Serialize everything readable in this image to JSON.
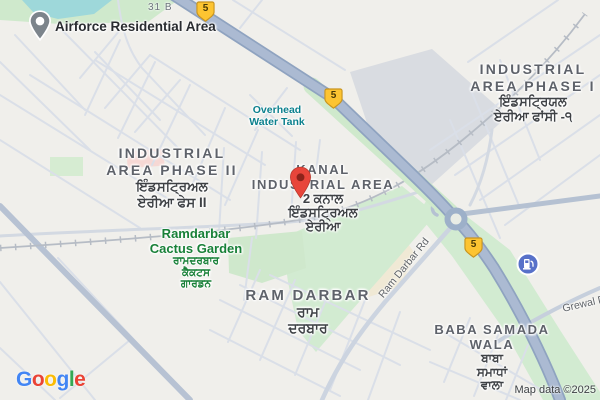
{
  "attribution": "Map data ©2025",
  "logo": {
    "letters": [
      "G",
      "o",
      "o",
      "g",
      "l",
      "e"
    ]
  },
  "badges": [
    {
      "label": "5"
    },
    {
      "label": "5"
    },
    {
      "label": "5"
    }
  ],
  "road_labels": {
    "plot": "31 B",
    "ram_darbar_rd": "Ram Darbar Rd",
    "grewal": "Grewal D"
  },
  "places": {
    "airforce": {
      "label": "Airforce Residential Area"
    },
    "water_tank": {
      "lines": [
        "Overhead",
        "Water Tank"
      ]
    },
    "phase2": {
      "lines": [
        "INDUSTRIAL",
        "AREA PHASE II",
        "ਇੰਡਸਟ੍ਰਿਅਲ",
        "ਏਰੀਆ ਫੇਸ II"
      ]
    },
    "kanal": {
      "lines": [
        "KANAL",
        "INDUSTRIAL AREA",
        "2 ਕਨਾਲ",
        "ਇੰਡਸਟ੍ਰਿਅਲ",
        "ਏਰੀਆ"
      ]
    },
    "phase1": {
      "lines": [
        "INDUSTRIAL",
        "AREA PHASE I",
        "ਇੰਡਸਟ੍ਰਿਯਲ",
        "ਏਰੀਆ ਫਾਂਸੀ -੧"
      ]
    },
    "cactus": {
      "lines": [
        "Ramdarbar",
        "Cactus Garden",
        "ਰਾਮਦਰਬਾਰ",
        "ਕੈਕਟਸ",
        "ਗਾਰਡਨ"
      ]
    },
    "ram_darbar": {
      "lines": [
        "RAM DARBAR",
        "ਰਾਮ",
        "ਦਰਬਾਰ"
      ]
    },
    "baba_samada": {
      "lines": [
        "BABA SAMADA",
        "WALA",
        "ਬਾਬਾ",
        "ਸਮਾਧਾਂ",
        "ਵਾਲਾ"
      ]
    }
  },
  "icons": {
    "destination_pin": "red-map-pin",
    "airforce_pin": "gray-area-pin",
    "fuel": "fuel-station"
  },
  "colors": {
    "highway": "#abbad2",
    "water": "#9ed8da",
    "park_green": "#d2ebd1",
    "pin_red": "#e8453a",
    "badge_yellow": "#fdc431",
    "poi_blue": "#5871c9",
    "label_green": "#188038",
    "label_teal": "#0b808d"
  }
}
